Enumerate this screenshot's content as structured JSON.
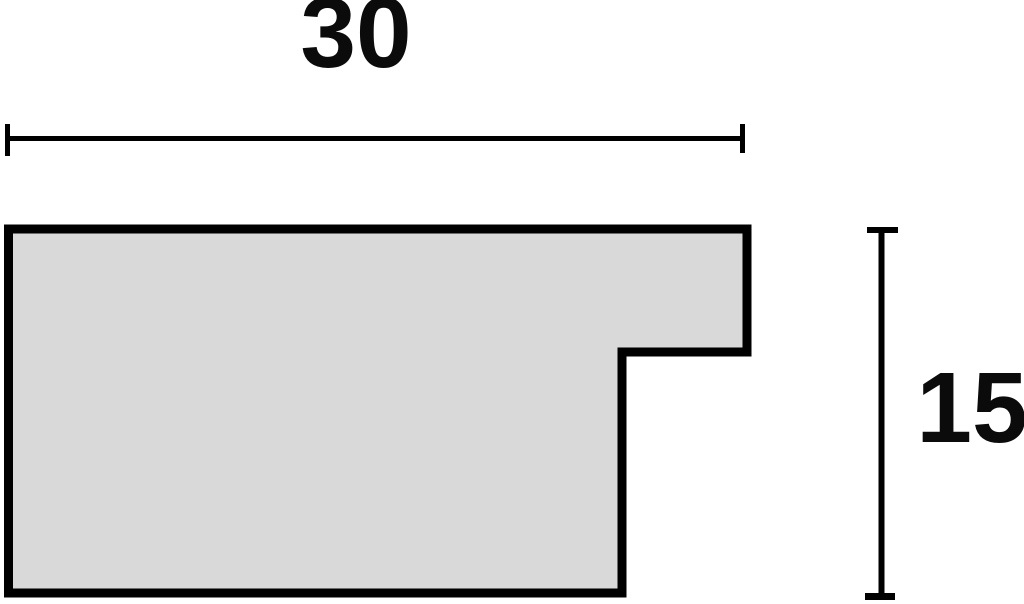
{
  "diagram": {
    "type": "cross-section profile drawing with dimensions",
    "width_dimension": {
      "label": "30"
    },
    "height_dimension": {
      "label": "15"
    },
    "colors": {
      "profile_fill": "#d9d9d9",
      "outline": "#000000",
      "background": "#ffffff"
    }
  }
}
